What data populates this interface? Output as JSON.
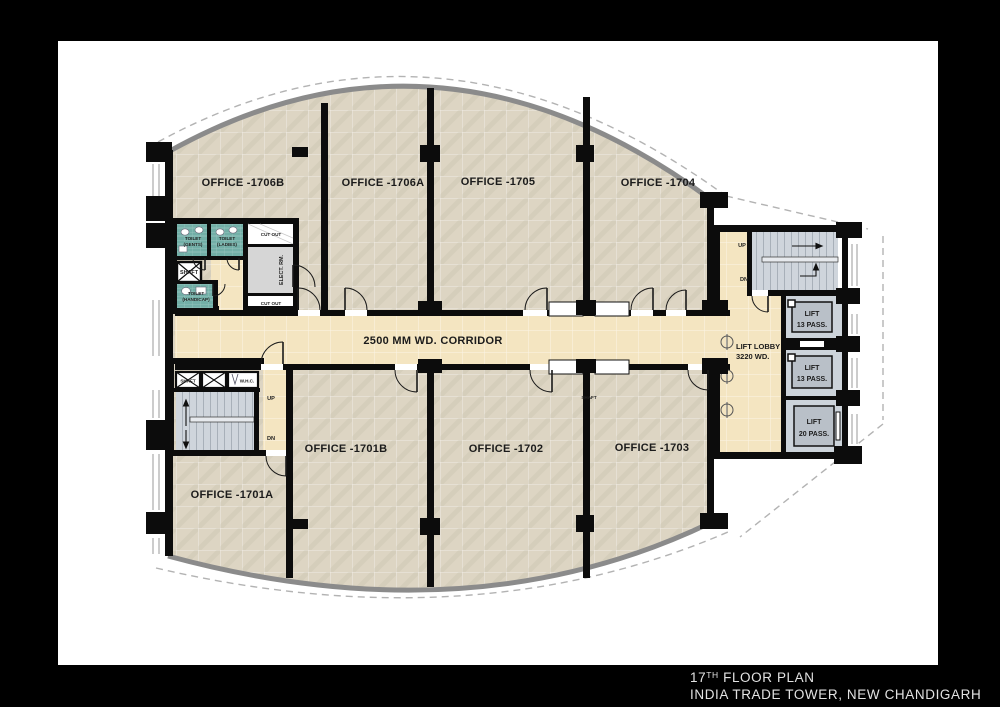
{
  "title_block": {
    "floor_num": "17",
    "floor_sup": "TH",
    "floor_rest": " FLOOR PLAN",
    "address": "INDIA TRADE TOWER, NEW CHANDIGARH"
  },
  "offices": {
    "o1706b": "OFFICE -1706B",
    "o1706a": "OFFICE -1706A",
    "o1705": "OFFICE -1705",
    "o1704": "OFFICE -1704",
    "o1701a": "OFFICE -1701A",
    "o1701b": "OFFICE -1701B",
    "o1702": "OFFICE -1702",
    "o1703": "OFFICE -1703"
  },
  "corridor": {
    "label": "2500 MM WD. CORRIDOR"
  },
  "lift_lobby": {
    "line1": "LIFT LOBBY",
    "line2": "3220 WD."
  },
  "lifts": {
    "lift1": {
      "line1": "LIFT",
      "line2": "13 PASS."
    },
    "lift2": {
      "line1": "LIFT",
      "line2": "13 PASS."
    },
    "lift3": {
      "line1": "LIFT",
      "line2": "20 PASS."
    }
  },
  "stairs": {
    "up": "UP",
    "dn": "DN"
  },
  "toilets": {
    "gents1": "TOILET",
    "gents2": "(GENTS)",
    "ladies1": "TOILET",
    "ladies2": "(LADIES)",
    "hc1": "TOILET",
    "hc2": "(HANDICAP)"
  },
  "service": {
    "shaft": "SHAFT",
    "wc": "W.H.C.",
    "elect": "ELECT. RM.",
    "cutout": "CUT OUT"
  },
  "colors": {
    "frame": "#000000",
    "paper": "#ffffff",
    "wall": "#0c0c0c",
    "office_floor": "#ddd5c3",
    "corridor_floor": "#f4e5c1",
    "toilet_tile": "#72afa7",
    "stair_floor": "#cfd5dc",
    "electrical_room": "#d6d6d6",
    "lift_room": "#ccd3da",
    "lift_car": "#b9c0c8",
    "outline_gray": "#8b8b8b",
    "title_text": "#e2e2e2"
  }
}
